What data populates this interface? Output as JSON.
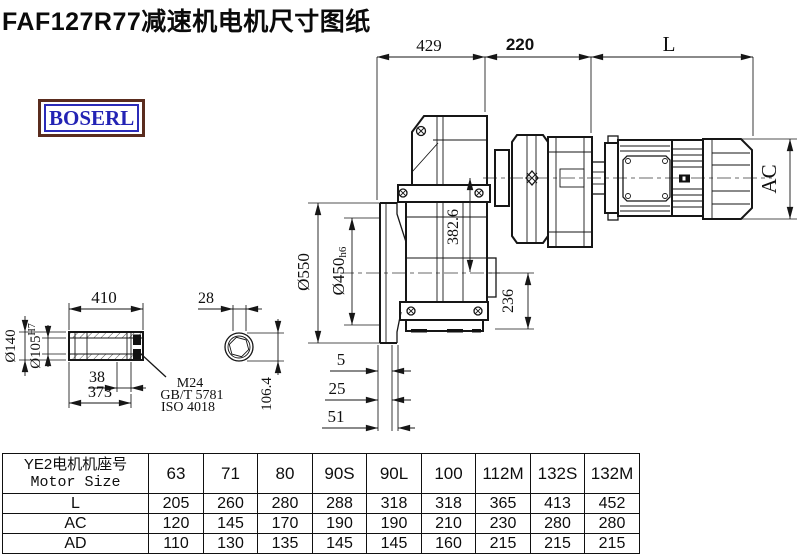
{
  "page": {
    "title": "FAF127R77减速机电机尺寸图纸"
  },
  "logo": {
    "text": "BOSERL"
  },
  "drawing": {
    "top_dims": {
      "width_429": "429",
      "width_220": "220",
      "motor_length": "L"
    },
    "motor_dims": {
      "ac": "AC"
    },
    "height_dims": {
      "axis_height": "382.6",
      "shaft_height": "236"
    },
    "flange_dims": {
      "flange_od": "Ø550",
      "spigot": "Ø450",
      "spigot_tol": "h6",
      "offset_5": "5",
      "offset_25": "25",
      "offset_51": "51"
    },
    "shaft_dims": {
      "length_410": "410",
      "hub_od": "Ø140",
      "bore_id": "Ø105",
      "bore_tol": "H7",
      "width_38": "38",
      "length_373": "373",
      "section_28": "28",
      "section_106": "106.4"
    },
    "notes": {
      "thread": "M24",
      "std1": "GB/T 5781",
      "std2": "ISO 4018"
    }
  },
  "table": {
    "header_cn": "YE2电机机座号",
    "header_en": "Motor Size",
    "columns": [
      "63",
      "71",
      "80",
      "90S",
      "90L",
      "100",
      "112M",
      "132S",
      "132M"
    ],
    "rows": [
      {
        "label": "L",
        "values": [
          "205",
          "260",
          "280",
          "288",
          "318",
          "318",
          "365",
          "413",
          "452"
        ]
      },
      {
        "label": "AC",
        "values": [
          "120",
          "145",
          "170",
          "190",
          "190",
          "210",
          "230",
          "280",
          "280"
        ]
      },
      {
        "label": "AD",
        "values": [
          "110",
          "130",
          "135",
          "145",
          "145",
          "160",
          "215",
          "215",
          "215"
        ]
      }
    ]
  },
  "colors": {
    "line": "#161616",
    "logo_text": "#2323b4",
    "logo_border": "#5a2c1e",
    "background": "#ffffff"
  }
}
